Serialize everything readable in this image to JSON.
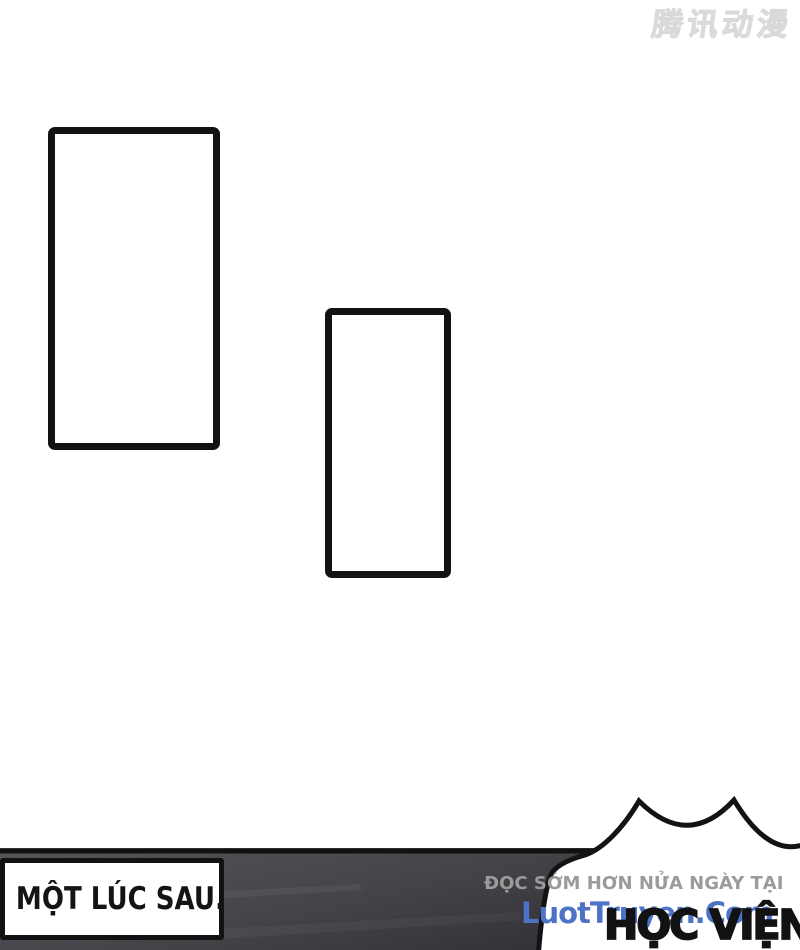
{
  "publisher_watermark": {
    "text": "腾讯动漫"
  },
  "caption_box": {
    "text": "MỘT LÚC SAU......"
  },
  "site_watermark": {
    "line1": "ĐỌC SỚM HƠN NỬA NGÀY TẠI",
    "line2": "LuotTruyen.Com",
    "line1_color": "#9b9b9b",
    "line2_color": "#4d73c6"
  },
  "speech_bubble": {
    "text": "HỌC VIỆN"
  },
  "colors": {
    "page_background": "#ffffff",
    "panel_outline": "#121212",
    "band_dark": "#48484d",
    "bubble_fill": "#ffffff"
  }
}
